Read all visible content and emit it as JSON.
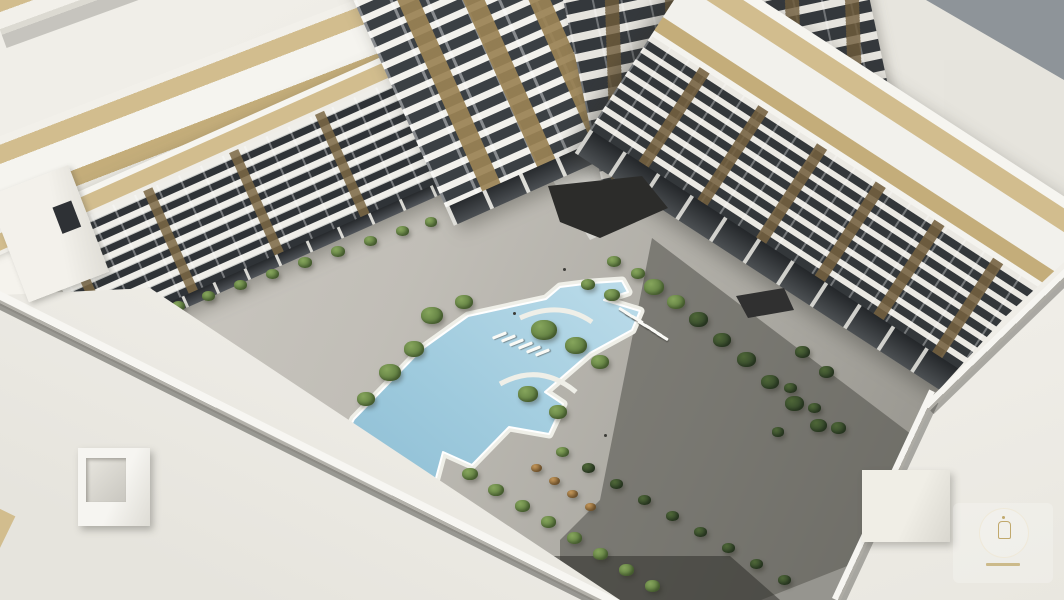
{
  "scene": {
    "description": "Aerial 3D architectural rendering of a white residential apartment complex enclosing a landscaped courtyard with a large angular swimming pool",
    "elements": {
      "buildings": [
        "left-wing",
        "center-tower",
        "back-buildings",
        "right-wing"
      ],
      "courtyard": [
        "swimming-pool",
        "pool-deck",
        "planters",
        "walkways",
        "sun-loungers",
        "entrance-canopy"
      ],
      "foreground": [
        "rooftop-left",
        "rooftop-right",
        "roof-bulkhead",
        "watermark-logo"
      ]
    },
    "watermark": {
      "shape": "circular-badge",
      "glyph": "lantern-icon",
      "text_legible": false
    }
  },
  "palette": {
    "ground": "#e7e5de",
    "tan": "#d2bd8e",
    "tan2": "#c4ad7a",
    "slab": "#efeee9",
    "win": "#2f3337",
    "gray": "#8e9499",
    "pool": "#9ecadd",
    "pool2": "#c2dfeb",
    "deck": "#f1f1ea",
    "wm": "#b5974d"
  },
  "landscape": {
    "planters": [
      [
        178,
        306,
        13,
        "g"
      ],
      [
        208,
        296,
        13,
        "g"
      ],
      [
        240,
        285,
        13,
        "g"
      ],
      [
        272,
        274,
        13,
        "g"
      ],
      [
        305,
        263,
        14,
        "g"
      ],
      [
        338,
        252,
        14,
        "g"
      ],
      [
        370,
        241,
        13,
        "g"
      ],
      [
        402,
        231,
        13,
        "g"
      ],
      [
        431,
        222,
        12,
        "g"
      ],
      [
        432,
        316,
        22,
        "g"
      ],
      [
        464,
        302,
        18,
        "g"
      ],
      [
        414,
        349,
        20,
        "g"
      ],
      [
        390,
        373,
        22,
        "g"
      ],
      [
        366,
        399,
        18,
        "g"
      ],
      [
        344,
        438,
        16,
        "g"
      ],
      [
        544,
        330,
        26,
        "g"
      ],
      [
        576,
        346,
        22,
        "g"
      ],
      [
        600,
        362,
        18,
        "g"
      ],
      [
        528,
        394,
        20,
        "g"
      ],
      [
        558,
        412,
        18,
        "g"
      ],
      [
        612,
        295,
        16,
        "g"
      ],
      [
        588,
        285,
        14,
        "g"
      ],
      [
        614,
        262,
        14,
        "g"
      ],
      [
        638,
        274,
        14,
        "g"
      ],
      [
        654,
        287,
        20,
        "g"
      ],
      [
        676,
        302,
        18,
        "g"
      ],
      [
        698,
        320,
        19,
        "d"
      ],
      [
        722,
        340,
        18,
        "d"
      ],
      [
        746,
        360,
        19,
        "d"
      ],
      [
        770,
        382,
        18,
        "d"
      ],
      [
        794,
        404,
        19,
        "d"
      ],
      [
        818,
        426,
        17,
        "d"
      ],
      [
        470,
        474,
        16,
        "g"
      ],
      [
        496,
        490,
        16,
        "g"
      ],
      [
        522,
        506,
        15,
        "g"
      ],
      [
        548,
        522,
        15,
        "g"
      ],
      [
        574,
        538,
        15,
        "g"
      ],
      [
        600,
        554,
        15,
        "g"
      ],
      [
        626,
        570,
        15,
        "g"
      ],
      [
        652,
        586,
        15,
        "g"
      ],
      [
        562,
        452,
        13,
        "g"
      ],
      [
        588,
        468,
        13,
        "d"
      ],
      [
        616,
        484,
        13,
        "d"
      ],
      [
        644,
        500,
        13,
        "d"
      ],
      [
        672,
        516,
        13,
        "d"
      ],
      [
        700,
        532,
        13,
        "d"
      ],
      [
        728,
        548,
        13,
        "d"
      ],
      [
        756,
        564,
        13,
        "d"
      ],
      [
        784,
        580,
        13,
        "d"
      ],
      [
        536,
        468,
        11,
        "a"
      ],
      [
        554,
        481,
        11,
        "a"
      ],
      [
        572,
        494,
        11,
        "a"
      ],
      [
        590,
        507,
        11,
        "a"
      ],
      [
        802,
        352,
        15,
        "d"
      ],
      [
        826,
        372,
        15,
        "d"
      ],
      [
        790,
        388,
        13,
        "d"
      ],
      [
        814,
        408,
        13,
        "d"
      ],
      [
        838,
        428,
        15,
        "d"
      ],
      [
        778,
        432,
        12,
        "d"
      ],
      [
        432,
        560,
        15,
        "g"
      ],
      [
        460,
        578,
        15,
        "g"
      ],
      [
        488,
        595,
        13,
        "g"
      ]
    ],
    "pool_steps": {
      "origin": [
        492,
        334
      ],
      "count": 6,
      "dx": 8.5,
      "dy": 3.4,
      "w": 15,
      "h": 3,
      "angle": -22
    },
    "loungers": {
      "origin": [
        618,
        310
      ],
      "count": 7,
      "dx": 6.4,
      "dy": 4.2,
      "w": 13,
      "h": 3,
      "angle": 32
    },
    "people": [
      [
        563,
        268
      ],
      [
        513,
        312
      ],
      [
        604,
        434
      ],
      [
        500,
        580
      ]
    ]
  }
}
